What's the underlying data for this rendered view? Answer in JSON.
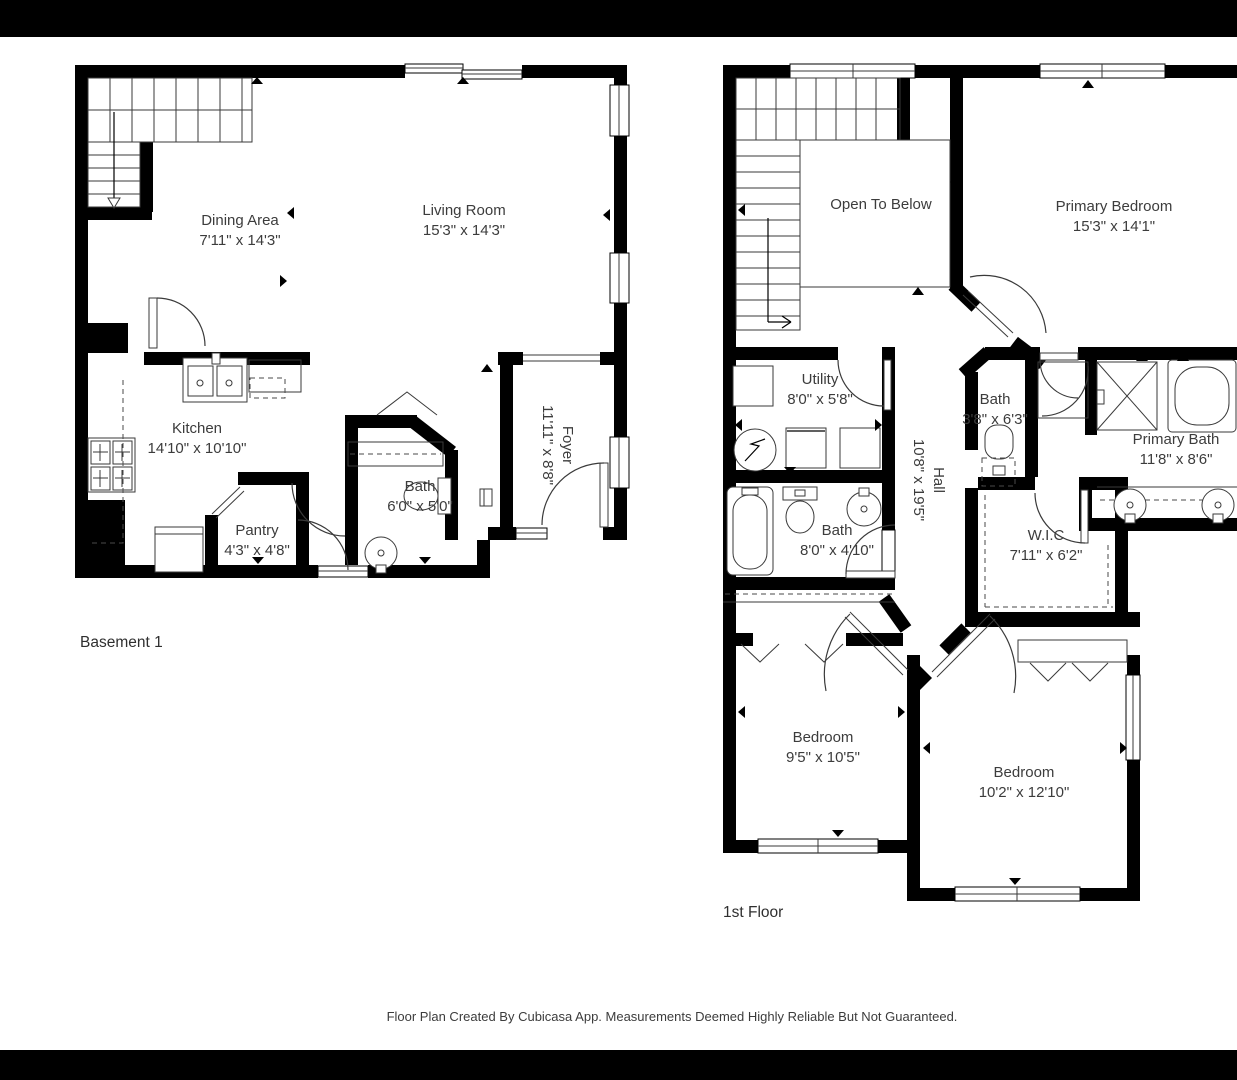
{
  "colors": {
    "wall": "#000000",
    "background": "#ffffff",
    "text": "#3c3c3c",
    "letterbox": "#000000"
  },
  "caption": "Floor Plan Created By Cubicasa App. Measurements Deemed Highly Reliable But Not Guaranteed.",
  "plans": [
    {
      "label": "Basement 1",
      "rooms": [
        {
          "name": "Dining Area",
          "dims": "7'11\" x 14'3\""
        },
        {
          "name": "Living Room",
          "dims": "15'3\" x 14'3\""
        },
        {
          "name": "Kitchen",
          "dims": "14'10\" x 10'10\""
        },
        {
          "name": "Pantry",
          "dims": "4'3\" x 4'8\""
        },
        {
          "name": "Bath",
          "dims": "6'0\" x 5'0\""
        },
        {
          "name": "Foyer",
          "dims": "11'11\" x 8'8\""
        }
      ]
    },
    {
      "label": "1st Floor",
      "rooms": [
        {
          "name": "Open To Below",
          "dims": ""
        },
        {
          "name": "Primary Bedroom",
          "dims": "15'3\" x 14'1\""
        },
        {
          "name": "Utility",
          "dims": "8'0\" x 5'8\""
        },
        {
          "name": "Bath",
          "dims": "8'0\" x 4'10\""
        },
        {
          "name": "Hall",
          "dims": "10'8\" x 19'5\""
        },
        {
          "name": "Bath",
          "dims": "3'8\" x 6'3\""
        },
        {
          "name": "Primary Bath",
          "dims": "11'8\" x 8'6\""
        },
        {
          "name": "W.I.C",
          "dims": "7'11\" x 6'2\""
        },
        {
          "name": "Bedroom",
          "dims": "9'5\" x 10'5\""
        },
        {
          "name": "Bedroom",
          "dims": "10'2\" x 12'10\""
        }
      ]
    }
  ]
}
